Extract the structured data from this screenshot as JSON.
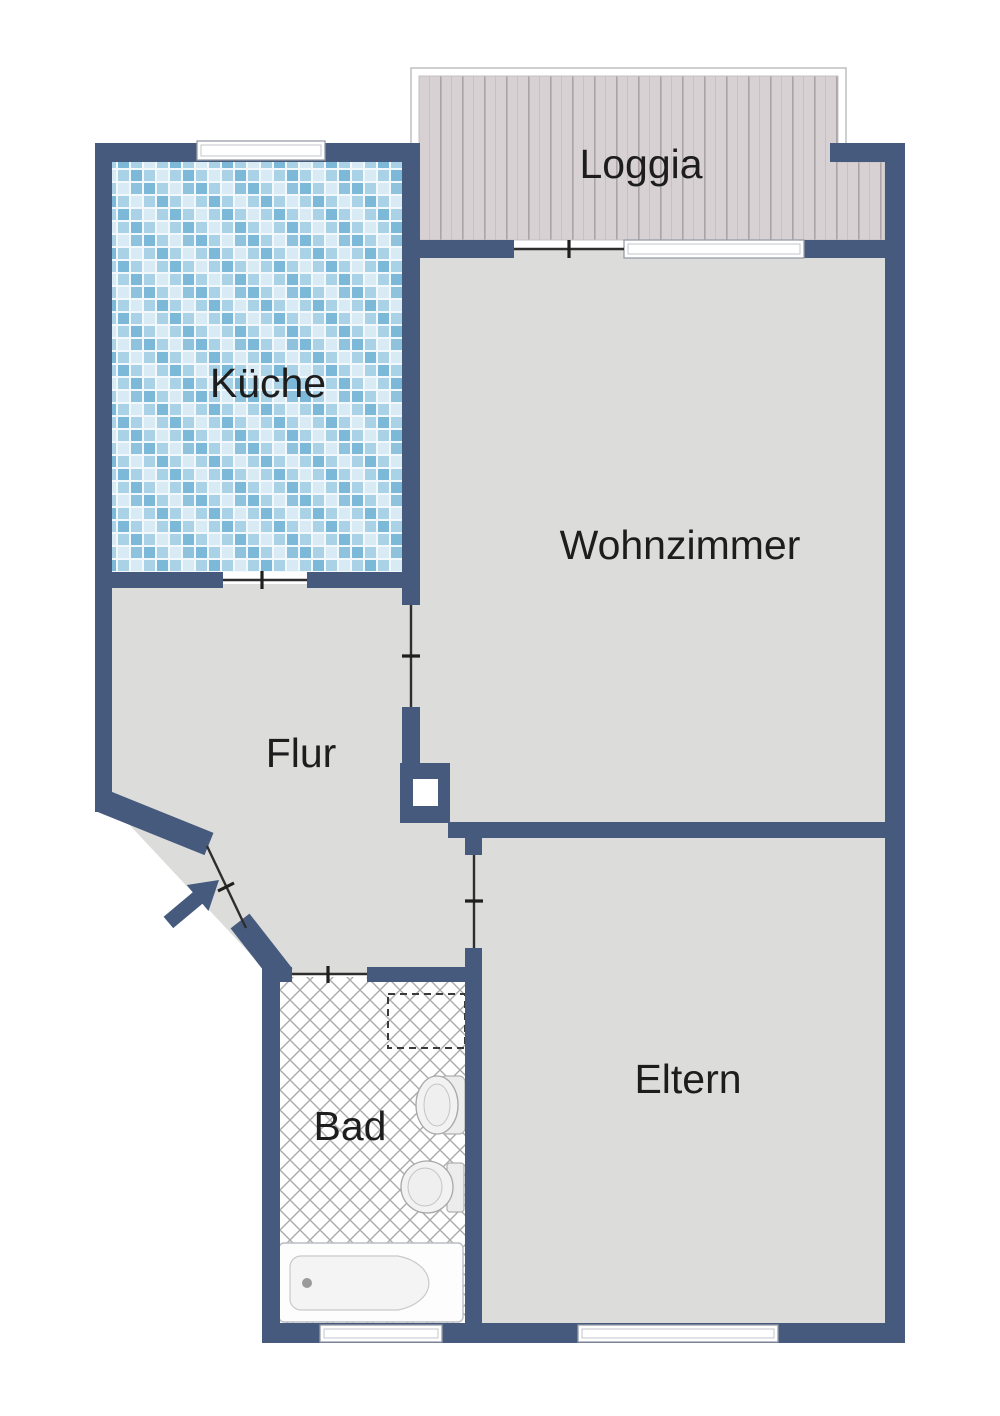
{
  "plan": {
    "rooms": [
      {
        "id": "loggia",
        "label": "Loggia"
      },
      {
        "id": "kueche",
        "label": "Küche"
      },
      {
        "id": "wohnzimmer",
        "label": "Wohnzimmer"
      },
      {
        "id": "flur",
        "label": "Flur"
      },
      {
        "id": "bad",
        "label": "Bad"
      },
      {
        "id": "eltern",
        "label": "Eltern"
      }
    ],
    "fixtures": {
      "bathtub": "bathtub",
      "sink": "sink",
      "toilet": "toilet",
      "washing_machine_space": "washing-machine-space",
      "entrance_arrow": "entrance-direction-arrow",
      "utility_column": "utility-shaft"
    },
    "colors": {
      "wall": "#465a7e",
      "floor": "#dcdcda",
      "loggia_plank": "#d7d1d3",
      "kitchen_tile_light": "#a9d2e6",
      "kitchen_tile_medium": "#7cb8d8",
      "kitchen_tile_pale": "#d8eaf3",
      "bath_lattice_line": "#ababab",
      "label_text": "#1d1d1d",
      "window_frame": "#979da7"
    }
  }
}
